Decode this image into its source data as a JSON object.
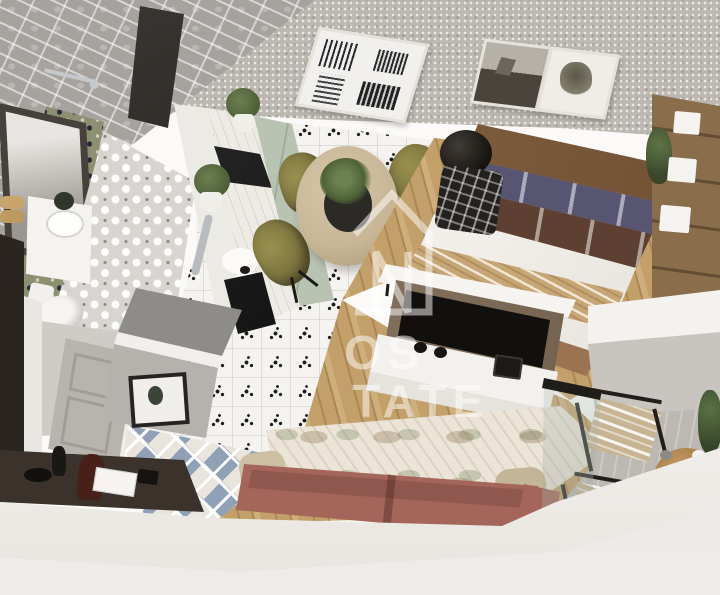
{
  "scene": {
    "description": "3D isometric cutaway rendering of a one-bedroom apartment floor plan",
    "view": "birds-eye isometric, white cutaway walls"
  },
  "watermark": {
    "logo": "house-outline-monogram",
    "logo_letter": "N",
    "line1": "OS",
    "line2": "TATE"
  },
  "palette": {
    "bg": "#fbfaf8",
    "wallpaper": "#bcb8b1",
    "tile-wall": "#a6a39e",
    "accent-olive": "#8d9070",
    "bath-floor": "#d8d5d0",
    "wall-gray": "#cfccc5",
    "door-gray": "#b7b4ad",
    "cut-white": "#f5f3f0",
    "exterior": "#d9d6d1",
    "console": "#3a322b",
    "hall-blue": "#8fa0b7",
    "hall-cream": "#e9e5dc",
    "cabinet-sage": "#b9c3b2",
    "counter": "#edebe4",
    "floor-tile": "#f5f3ef",
    "wood": "#c3a069",
    "table": "#c7b596",
    "olive": "#8a8148",
    "headboard": "#8d6a48",
    "pillow-purple": "#575571",
    "pillow-brown": "#5d4032",
    "duvet": "#f1eee9",
    "throw": "#c7a676",
    "rug-blue": "#8290ad",
    "wardrobe": "#8a6e4c",
    "bronze": "#7d6c59",
    "screen": "#12100e",
    "media": "#f3f1ed",
    "sofa": "#a4665a",
    "rug-living": "#ebe4d7",
    "concrete": "#bcb9b3",
    "cushion": "#c7b493",
    "frame-dark": "#211f1c",
    "green": "#4e6238",
    "watermark": "rgba(255,255,255,0.5)"
  },
  "rooms": {
    "bathroom": {
      "items": [
        "shower",
        "mirror",
        "floating-vanity",
        "sink",
        "toilet",
        "towels",
        "hex-accent-wall",
        "quatrefoil-tile-floor"
      ]
    },
    "kitchen": {
      "items": [
        "sage-cabinets",
        "marble-counter",
        "black-cooktop",
        "oven",
        "sink",
        "potted-plants",
        "gray-tall-cabinet",
        "framed-print",
        "dot-pattern-tile-floor"
      ]
    },
    "dining": {
      "items": [
        "round-table",
        "centerpiece-plant",
        "olive-chair-x4"
      ]
    },
    "bedroom": {
      "items": [
        "double-bed",
        "leather-headboard",
        "purple-pillows",
        "brown-pillows",
        "patterned-throw",
        "blue-rug",
        "plaid-armchair",
        "black-floor-lamp",
        "wall-art-x2",
        "wood-shelf-unit",
        "storage-boxes",
        "plant"
      ]
    },
    "living_room": {
      "items": [
        "tv",
        "bronze-media-panel",
        "white-media-cabinet",
        "terracotta-sofa",
        "beige-pillows",
        "botanical-rug",
        "wood-floor"
      ]
    },
    "balcony": {
      "items": [
        "glass-partition",
        "lounge-chair-x2",
        "round-side-table",
        "tea-set",
        "plant",
        "concrete-floor"
      ]
    },
    "hallway": {
      "items": [
        "entry-door",
        "console-table",
        "decor-objects",
        "diamond-tile-floor"
      ]
    }
  }
}
